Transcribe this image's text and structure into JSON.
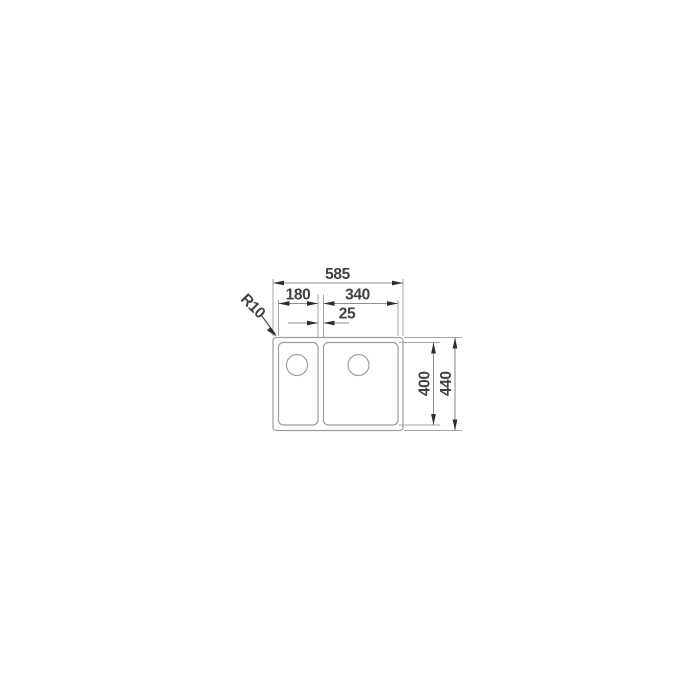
{
  "drawing": {
    "type": "sink-installation-technical-drawing",
    "labels": {
      "width_overall": "585",
      "width_left_bowl": "180",
      "width_right_bowl": "340",
      "divider_width": "25",
      "corner_radius": "R10",
      "depth_inner": "400",
      "depth_overall": "440"
    },
    "colors": {
      "outline": "#9e9e9e",
      "dimension_line": "#8f8f8f",
      "extension_line": "#a5a5a5",
      "arrow_ink": "#2e2e2e",
      "text_ink": "#404040",
      "background": "#ffffff"
    }
  }
}
